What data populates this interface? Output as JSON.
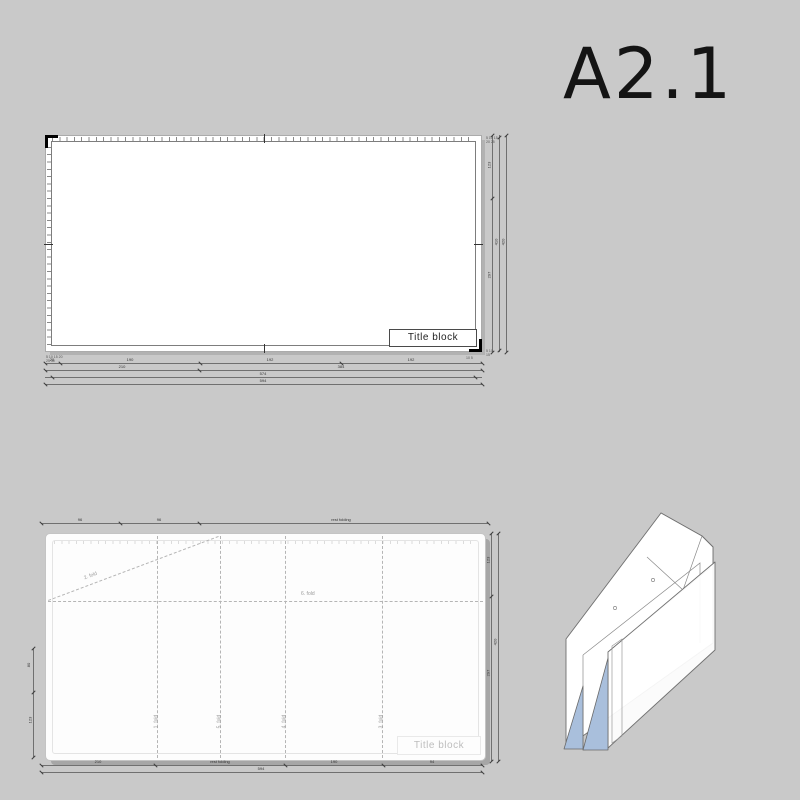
{
  "format_label": {
    "text": "A2.1"
  },
  "colors": {
    "background": "#c9c9c9",
    "sheet": "#ffffff",
    "dim_line": "#5a5a5a",
    "fold_line": "#b5b5b5",
    "frame": "#7d7d7d",
    "shadow": "#a6a6a6",
    "muted_text": "#bdbdbd",
    "corner_mark": "#000000"
  },
  "sheet_drawing": {
    "title_block": "Title block",
    "bottom_chains": [
      {
        "segments": [
          "20",
          "190",
          "192",
          "192"
        ]
      },
      {
        "segments": [
          "210",
          "384"
        ]
      },
      {
        "segments": [
          "574"
        ]
      },
      {
        "segments": [
          "594"
        ]
      }
    ],
    "right_chains": [
      {
        "segments": [
          "123",
          "297"
        ]
      },
      {
        "segments": [
          "410"
        ]
      },
      {
        "segments": [
          "420"
        ]
      }
    ],
    "micro_labels": {
      "bottom_left_1": "5 10 15 20",
      "bottom_left_2": "25 30",
      "bottom_right": "10 5",
      "top_right_1": "5 10 15",
      "top_right_2": "20 25",
      "bottom_right_cols_1": "5 10",
      "bottom_right_cols_2": "15"
    }
  },
  "fold_diagram": {
    "title_block": "Title block",
    "fold_labels": {
      "diagonal": "2. fold",
      "horizontal": "6. fold",
      "verticals": [
        "1. fold",
        "5. fold",
        "4. fold",
        "3. fold"
      ]
    },
    "chains": {
      "top": [
        "96",
        "96",
        "rest folding"
      ],
      "bottom_primary": [
        "210",
        "rest folding",
        "190",
        "94"
      ],
      "bottom_total": [
        "594"
      ],
      "left": [
        "80",
        "123"
      ],
      "right_inner": [
        "123",
        "297"
      ],
      "right_total": [
        "420"
      ]
    }
  },
  "iso_view": {
    "white": "#ffffff",
    "blue": "#a9bfdc",
    "stroke": "#707070"
  }
}
